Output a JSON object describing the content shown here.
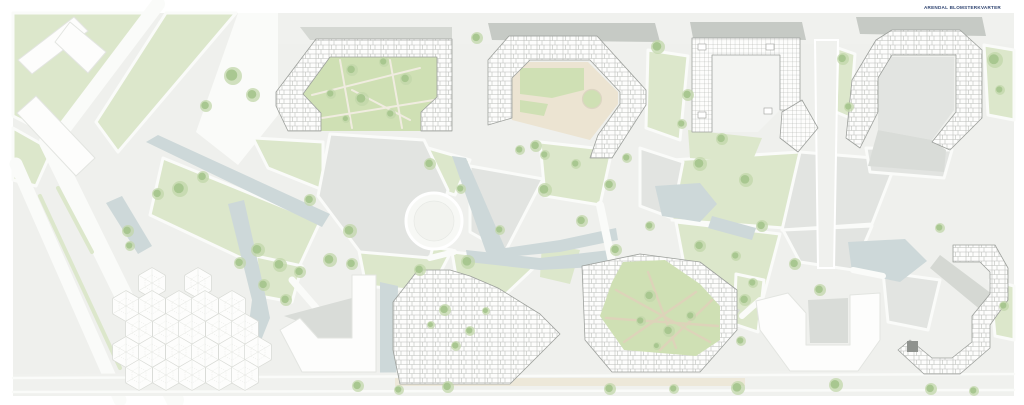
{
  "header": {
    "project_label": "ARENDAL BLOMSTERKVARTER"
  },
  "colors": {
    "ground": "#eff0ed",
    "road": "#fafbf9",
    "road-light": "#f0f1ee",
    "plaza": "#e2e4e1",
    "plaza-dark": "#d9dcd8",
    "shadow": "#c6cac5",
    "lawn": "#dce7cb",
    "lawn-bright": "#cfe0b4",
    "water": "#cdd8d9",
    "sand": "#ece4d2",
    "sand-dark": "#ddd3b9",
    "build-white": "#fdfdfc",
    "outline": "#9da09c",
    "room-line": "#b9bcb8",
    "grid-line": "#a8aba7",
    "court-light": "#f3f4f2",
    "tree-outer": "#c2d7aa",
    "tree-inner": "#a4c48c",
    "hex-fill": "#fdfdfc",
    "hex-line": "#d8dad5",
    "hex-inner": "#e4e6e1",
    "navy": "#2e4370",
    "dark-core": "#8f928e"
  },
  "plan": {
    "trees": [
      [
        233,
        76,
        9
      ],
      [
        253,
        95,
        7
      ],
      [
        206,
        106,
        6
      ],
      [
        180,
        189,
        8
      ],
      [
        203,
        177,
        6
      ],
      [
        158,
        194,
        6
      ],
      [
        128,
        231,
        6
      ],
      [
        130,
        246,
        5
      ],
      [
        258,
        250,
        7
      ],
      [
        240,
        263,
        6
      ],
      [
        280,
        265,
        7
      ],
      [
        300,
        272,
        6
      ],
      [
        264,
        285,
        6
      ],
      [
        286,
        300,
        6
      ],
      [
        330,
        260,
        7
      ],
      [
        352,
        264,
        6
      ],
      [
        352,
        70,
        6
      ],
      [
        384,
        62,
        5
      ],
      [
        362,
        99,
        7
      ],
      [
        331,
        94,
        5
      ],
      [
        406,
        79,
        6
      ],
      [
        391,
        114,
        5
      ],
      [
        346,
        119,
        4
      ],
      [
        310,
        200,
        6
      ],
      [
        350,
        231,
        7
      ],
      [
        430,
        164,
        6
      ],
      [
        461,
        189,
        5
      ],
      [
        420,
        270,
        6
      ],
      [
        468,
        262,
        7
      ],
      [
        500,
        230,
        5
      ],
      [
        477,
        38,
        6
      ],
      [
        545,
        190,
        7
      ],
      [
        536,
        146,
        6
      ],
      [
        576,
        164,
        5
      ],
      [
        610,
        185,
        6
      ],
      [
        627,
        158,
        5
      ],
      [
        582,
        221,
        6
      ],
      [
        616,
        250,
        6
      ],
      [
        650,
        226,
        5
      ],
      [
        658,
        47,
        7
      ],
      [
        688,
        95,
        6
      ],
      [
        682,
        124,
        5
      ],
      [
        700,
        164,
        7
      ],
      [
        722,
        139,
        6
      ],
      [
        746,
        180,
        7
      ],
      [
        762,
        226,
        6
      ],
      [
        700,
        246,
        6
      ],
      [
        736,
        256,
        5
      ],
      [
        795,
        264,
        6
      ],
      [
        820,
        290,
        6
      ],
      [
        843,
        59,
        6
      ],
      [
        849,
        107,
        5
      ],
      [
        995,
        60,
        8
      ],
      [
        1000,
        90,
        5
      ],
      [
        940,
        228,
        5
      ],
      [
        1004,
        306,
        5
      ],
      [
        445,
        310,
        6
      ],
      [
        470,
        331,
        5
      ],
      [
        456,
        346,
        5
      ],
      [
        431,
        325,
        4
      ],
      [
        486,
        311,
        4
      ],
      [
        650,
        296,
        6
      ],
      [
        641,
        321,
        5
      ],
      [
        669,
        331,
        6
      ],
      [
        691,
        316,
        5
      ],
      [
        657,
        346,
        4
      ],
      [
        745,
        300,
        6
      ],
      [
        753,
        283,
        5
      ],
      [
        741,
        341,
        5
      ],
      [
        358,
        386,
        6
      ],
      [
        399,
        390,
        5
      ],
      [
        448,
        387,
        6
      ],
      [
        610,
        389,
        6
      ],
      [
        674,
        389,
        5
      ],
      [
        738,
        388,
        7
      ],
      [
        836,
        385,
        7
      ],
      [
        931,
        389,
        6
      ],
      [
        974,
        391,
        5
      ],
      [
        520,
        150,
        5
      ],
      [
        545,
        155,
        5
      ]
    ],
    "hex_pavilion": {
      "radius": 15.5,
      "centers": [
        [
          152,
          283
        ],
        [
          198,
          283
        ],
        [
          126,
          306
        ],
        [
          152,
          306
        ],
        [
          179,
          306
        ],
        [
          205,
          306
        ],
        [
          232,
          306
        ],
        [
          139,
          329
        ],
        [
          166,
          329
        ],
        [
          192,
          329
        ],
        [
          219,
          329
        ],
        [
          245,
          329
        ],
        [
          126,
          352
        ],
        [
          152,
          352
        ],
        [
          179,
          352
        ],
        [
          205,
          352
        ],
        [
          232,
          352
        ],
        [
          258,
          352
        ],
        [
          139,
          375
        ],
        [
          166,
          375
        ],
        [
          192,
          375
        ],
        [
          219,
          375
        ],
        [
          245,
          375
        ]
      ]
    }
  }
}
